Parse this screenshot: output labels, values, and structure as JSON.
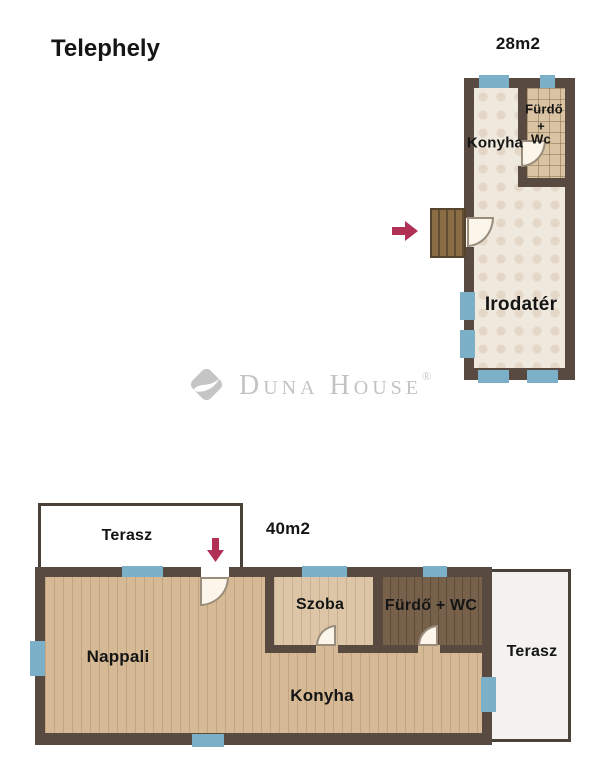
{
  "header": {
    "title": "Telephely"
  },
  "watermark": {
    "brand": "Duna House",
    "registered_mark": "®"
  },
  "upper_plan": {
    "area": "28m2",
    "rooms": {
      "konyha": "Konyha",
      "furdo": "Fürdő",
      "plus": "+",
      "wc": "Wc",
      "irodater": "Irodatér"
    }
  },
  "lower_plan": {
    "area": "40m2",
    "rooms": {
      "terasz_top": "Terasz",
      "nappali": "Nappali",
      "szoba": "Szoba",
      "furdo_wc": "Fürdő + WC",
      "konyha": "Konyha",
      "terasz_right": "Terasz"
    }
  },
  "icons": {
    "upper_entrance": "arrow-right-icon",
    "lower_entrance": "arrow-down-icon",
    "logo": "duna-house-diamond-icon"
  },
  "colors": {
    "wall": "#584a40",
    "terrace_border": "#4a4138",
    "window_blue": "#7cb0c8",
    "floor_cream": "#efe8dd",
    "floor_tile": "#d9c3a2",
    "floor_wood_light": "#d5ba95",
    "floor_wood_szoba": "#dcc6a7",
    "floor_wood_dark": "#77614b",
    "stairs_wood": "#8a6d44",
    "entrance_arrow": "#b13156",
    "watermark_gray": "#c3c3c3"
  }
}
